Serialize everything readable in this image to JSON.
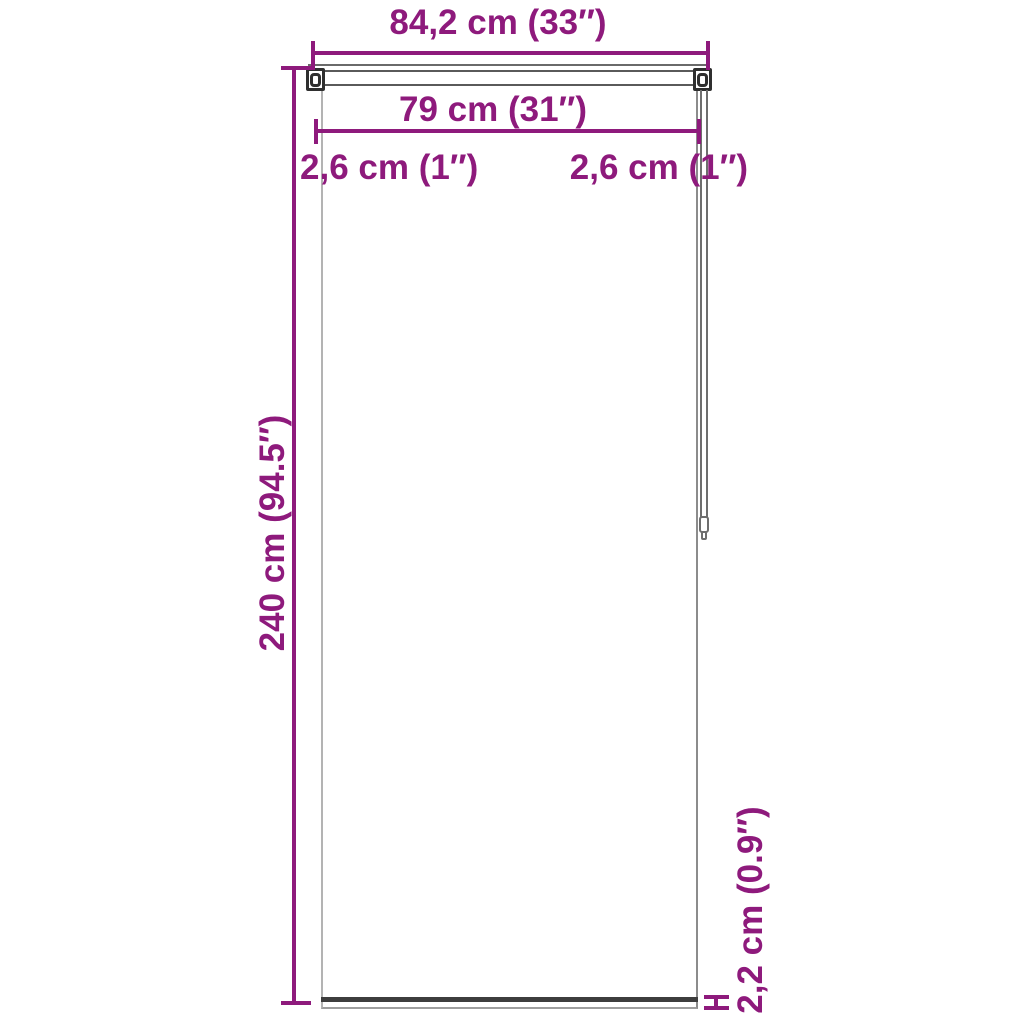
{
  "diagram": {
    "product": "roller-blind-dimension-drawing",
    "colors": {
      "accent": "#8E1A7C",
      "hardware_line": "#4a4a4a",
      "bottom_bar": "#3d3d3d"
    },
    "labels": {
      "total_width": "84,2 cm (33″)",
      "fabric_width": "79 cm (31″)",
      "left_offset": "2,6 cm (1″)",
      "right_offset": "2,6 cm (1″)",
      "height": "240 cm (94.5″)",
      "bottom_bar_height": "2,2 cm (0.9″)"
    }
  }
}
